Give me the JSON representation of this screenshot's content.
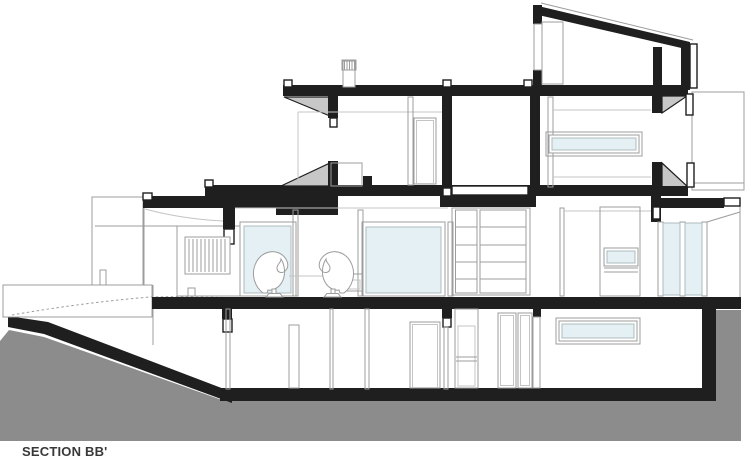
{
  "drawing": {
    "title": "SECTION BB'"
  },
  "colors": {
    "ink": "#1f1f1f",
    "terrain": "#8c8c8c",
    "poche": "#c7c7c7",
    "glass": "#e4f0f4",
    "glass_frame": "#adbcc0",
    "outline": "#9c9c9c",
    "outline_light": "#c4c4c4",
    "label": "#383838"
  }
}
